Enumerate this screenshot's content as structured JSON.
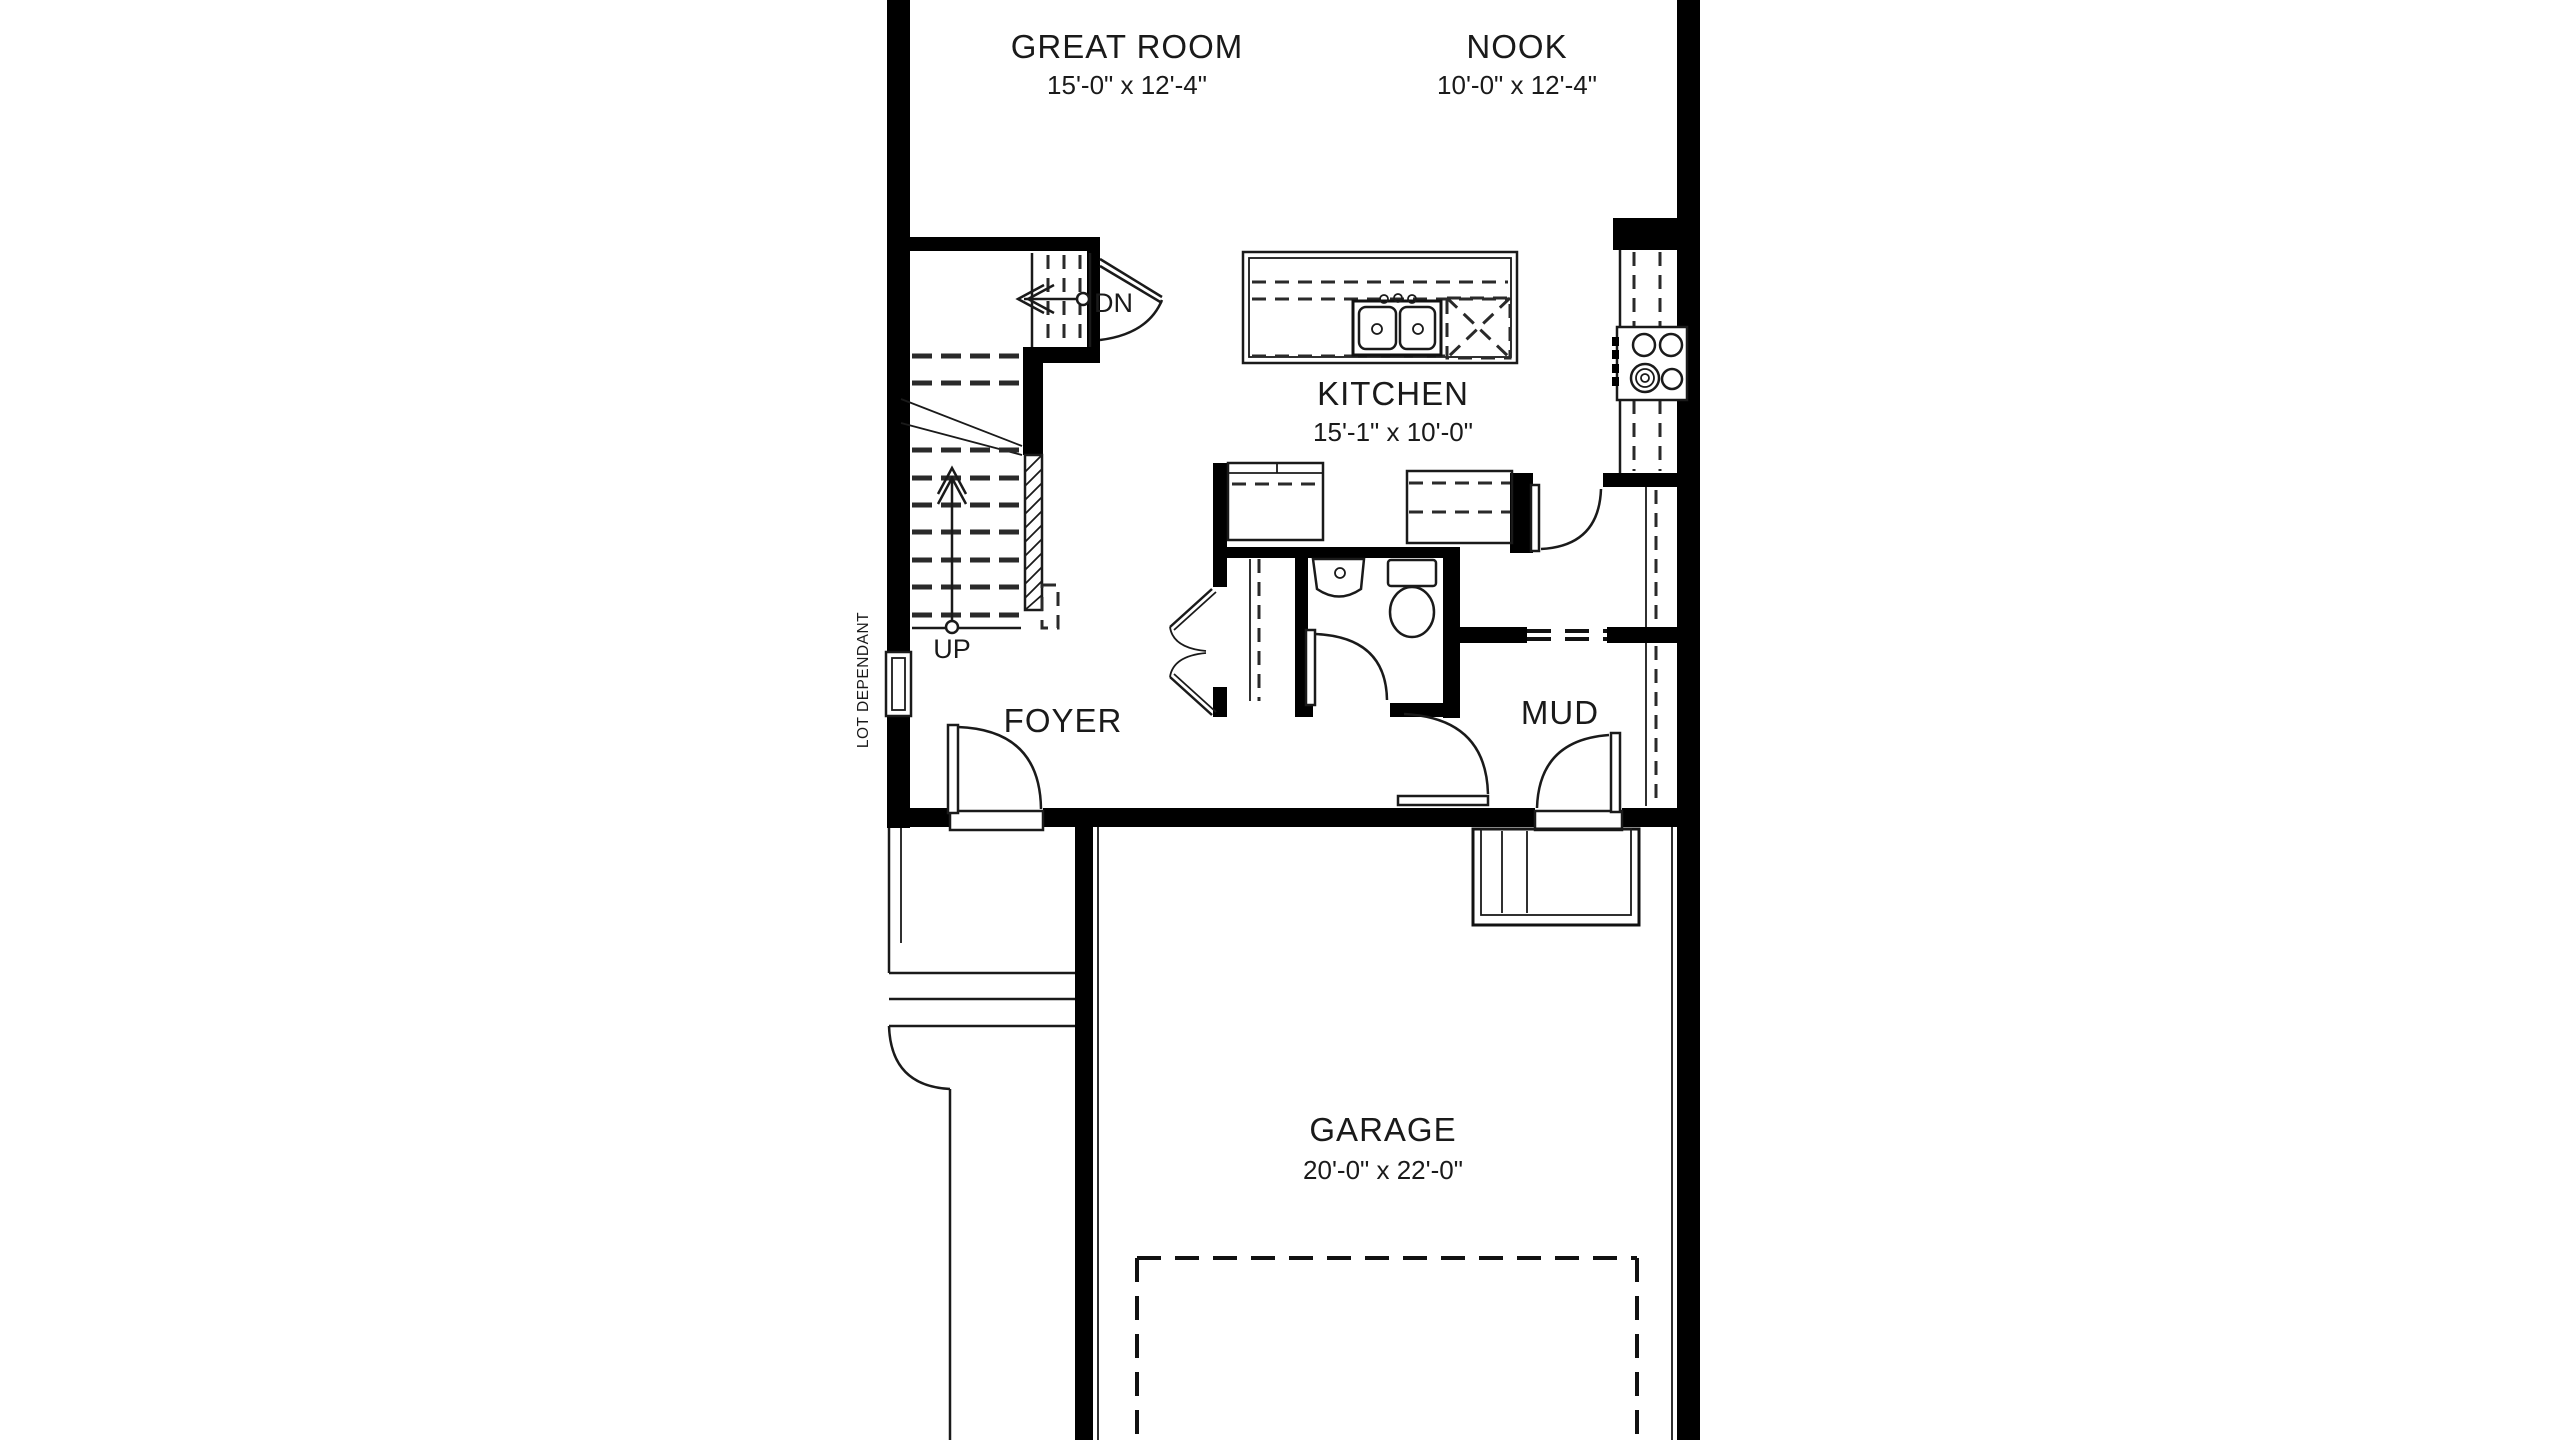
{
  "drawing": {
    "type": "floor-plan",
    "level": "main floor (partial view)"
  },
  "rooms": {
    "great_room": {
      "name": "GREAT ROOM",
      "dims": "15'-0\" x 12'-4\""
    },
    "nook": {
      "name": "NOOK",
      "dims": "10'-0\" x 12'-4\""
    },
    "kitchen": {
      "name": "KITCHEN",
      "dims": "15'-1\" x 10'-0\""
    },
    "foyer": {
      "name": "FOYER",
      "dims": ""
    },
    "mud": {
      "name": "MUD",
      "dims": ""
    },
    "garage": {
      "name": "GARAGE",
      "dims": "20'-0\" x 22'-0\""
    }
  },
  "stairs": {
    "up": "UP",
    "down": "DN"
  },
  "notes": {
    "lot_dependant": "LOT DEPENDANT"
  },
  "fixtures": [
    "kitchen-island",
    "double-sink",
    "dishwasher",
    "range",
    "wall-counter",
    "pantry-bifold-closet",
    "toilet",
    "vanity-sink",
    "front-door",
    "mud-garage-door",
    "powder-door",
    "basement-stair-door",
    "stair-up-run",
    "stair-down-landing",
    "porch-steps",
    "garage-landing",
    "garage-parking-outline",
    "window"
  ],
  "colors": {
    "wall": "#000000",
    "line": "#1a1a1a",
    "background": "#ffffff"
  }
}
